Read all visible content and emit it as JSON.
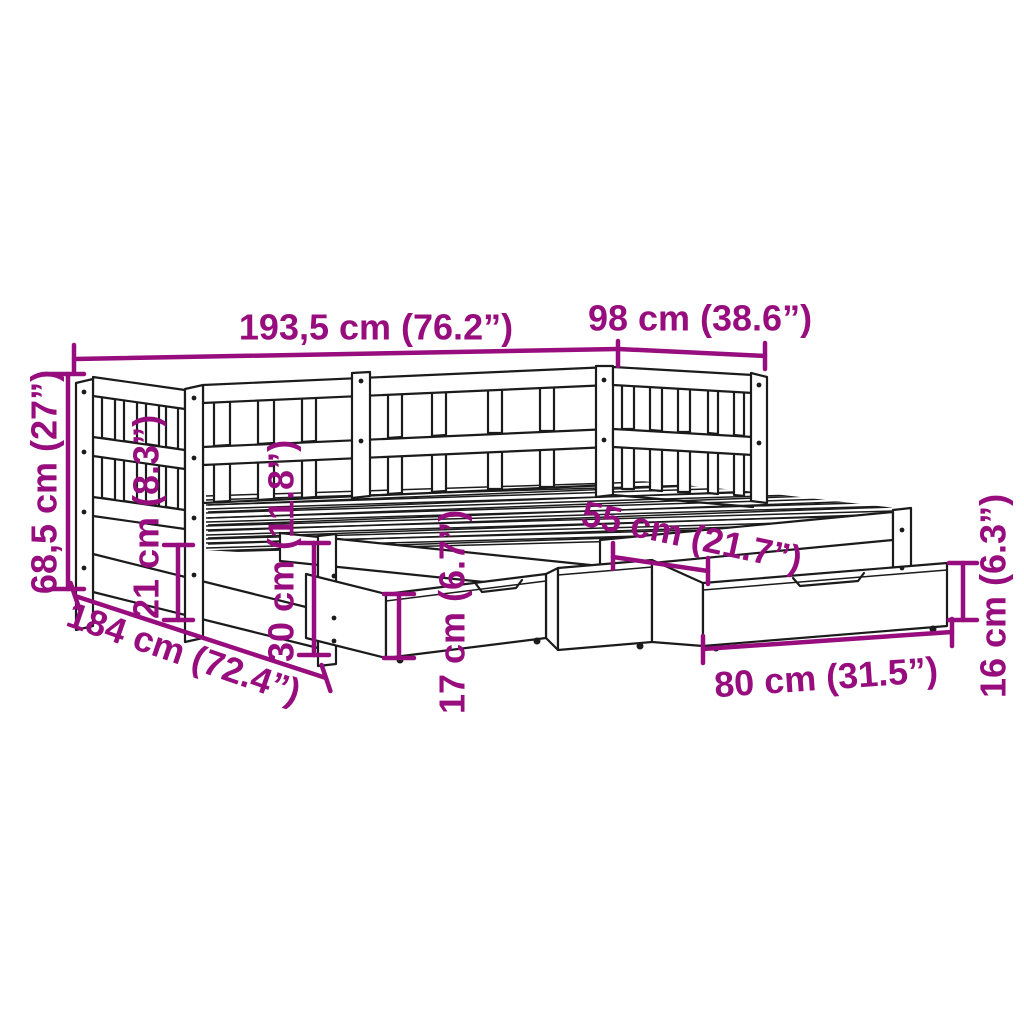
{
  "diagram": {
    "subject": "Daybed with slatted frame, pull-out trundle and storage drawers - dimension diagram",
    "accent_color": "#970d7e",
    "line_color": "#1b1b1b",
    "background_color": "#ffffff"
  },
  "dimensions": {
    "overall_length": {
      "label": "193,5 cm (76.2”)",
      "cm": "193,5",
      "inches": "76.2"
    },
    "overall_width": {
      "label": "98 cm (38.6”)",
      "cm": "98",
      "inches": "38.6"
    },
    "overall_height": {
      "label": "68,5 cm (27”)",
      "cm": "68,5",
      "inches": "27"
    },
    "rail_height": {
      "label": "21 cm (8.3”)",
      "cm": "21",
      "inches": "8.3"
    },
    "underbed_clearance": {
      "label": "30 cm (11.8”)",
      "cm": "30",
      "inches": "11.8"
    },
    "trundle_length": {
      "label": "184 cm (72.4”)",
      "cm": "184",
      "inches": "72.4"
    },
    "drawer_front_height": {
      "label": "17 cm (6.7”)",
      "cm": "17",
      "inches": "6.7"
    },
    "drawer_depth": {
      "label": "55 cm (21.7”)",
      "cm": "55",
      "inches": "21.7"
    },
    "drawer_width": {
      "label": "80 cm (31.5”)",
      "cm": "80",
      "inches": "31.5"
    },
    "drawer_side_height": {
      "label": "16 cm (6.3”)",
      "cm": "16",
      "inches": "6.3"
    }
  }
}
